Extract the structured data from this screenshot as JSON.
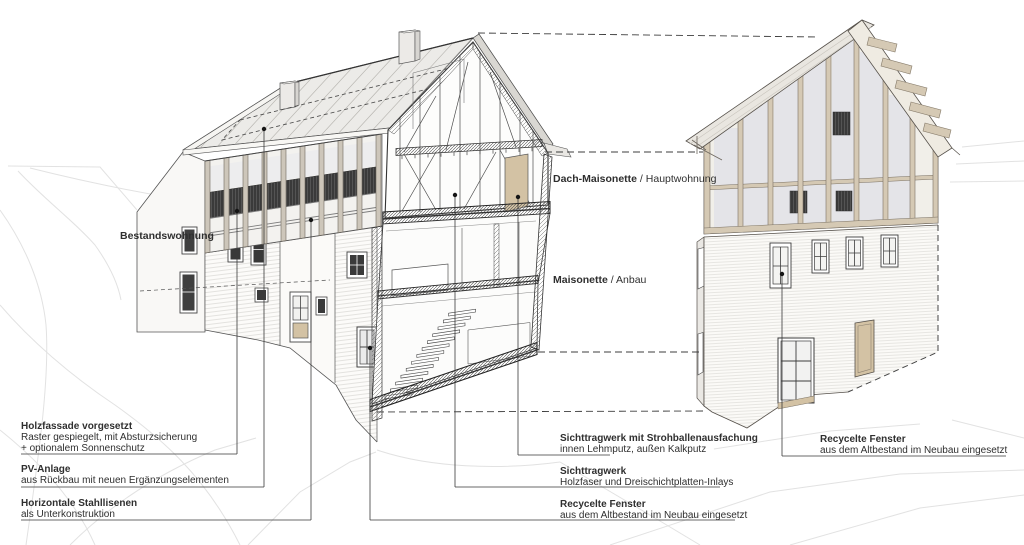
{
  "annotations": {
    "bestandswohnung": "Bestandswohnung",
    "dach_maisonette": {
      "bold": "Dach-Maisonette",
      "rest": " / Hauptwohnung"
    },
    "maisonette": {
      "bold": "Maisonette",
      "rest": " / Anbau"
    },
    "left": [
      {
        "title": "Holzfassade vorgesetzt",
        "line1": "Raster gespiegelt, mit Absturzsicherung",
        "line2": "+ optionalem Sonnenschutz"
      },
      {
        "title": "PV-Anlage",
        "line1": "aus Rückbau mit neuen Ergänzungselementen"
      },
      {
        "title": "Horizontale Stahllisenen",
        "line1": "als Unterkonstruktion"
      }
    ],
    "center": [
      {
        "title": "Sichttragwerk mit Strohballenausfachung",
        "line1": "innen Lehmputz, außen Kalkputz"
      },
      {
        "title": "Sichttragwerk",
        "line1": "Holzfaser und Dreischichtplatten-Inlays"
      },
      {
        "title": "Recycelte Fenster",
        "line1": "aus dem Altbestand im Neubau eingesetzt"
      }
    ],
    "right": [
      {
        "title": "Recycelte Fenster",
        "line1": "aus dem Altbestand im Neubau eingesetzt"
      }
    ]
  },
  "colors": {
    "paper": "#ffffff",
    "ink": "#2f2f2f",
    "timber": "#d5c9b4",
    "tan": "#d3c2a4",
    "railing_dark": "#3a3a3a",
    "roof_metal": "#ecebe8",
    "glass": "#e4e4e8",
    "site_line": "#e2e2e2"
  }
}
